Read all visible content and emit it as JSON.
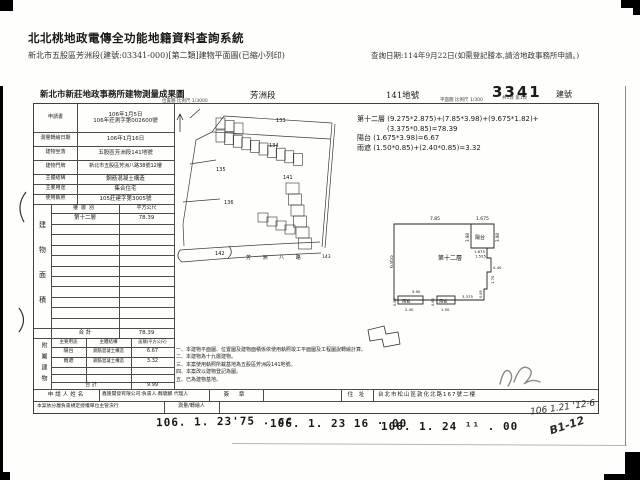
{
  "header": {
    "system_title": "北北桃地政電傳全功能地籍資料查詢系統",
    "doc_subtitle": "新北市五股區芳洲段(建號:03341-000)[第二類]建物平面圖(已縮小列印)",
    "query_date": "查詢日期:114年9月22日(如需登記謄本,請洽地政事務所申請。)"
  },
  "form_header": {
    "office_title": "新北市新莊地政事務所建物測量成果圖",
    "section_name": "芳洲段",
    "land_no": "141地號",
    "building_no": "3341",
    "building_no_label": "建號",
    "map_scale": "位置圖 比例尺 1/3000",
    "plan_scale": "平面圖 比例尺 1/300",
    "page_info": "共1頁 第1頁"
  },
  "info_table": {
    "rows": [
      {
        "label": "申請書",
        "value": "106年1月5日",
        "value2": "106年莊測字第002600號"
      },
      {
        "label": "測量轉繪日期",
        "value": "106年1月16日"
      },
      {
        "label": "建物坐落",
        "value": "五股區芳洲段141地號"
      },
      {
        "label": "建物門牌",
        "value": "新北市五股區芳洲八路38號12樓"
      },
      {
        "label": "主體結構",
        "value": "鋼筋混凝土構造"
      },
      {
        "label": "主要用途",
        "value": "集合住宅"
      },
      {
        "label": "使用執照",
        "value": "105莊建字第3005號"
      }
    ]
  },
  "floor_area_table": {
    "side_label": "建物面積",
    "col1": "樓層別",
    "col2": "平方公尺",
    "floor_label": "第十二層",
    "floor_area": "78.39",
    "total_label": "合  計",
    "total_area": "78.39"
  },
  "annex_table": {
    "side_label": "附屬建物",
    "col1": "主要用途",
    "col2": "主體結構",
    "col3": "面積(平方公尺)",
    "rows": [
      {
        "use": "陽台",
        "structure": "鋼筋混凝土構造",
        "area": "6.67"
      },
      {
        "use": "雨遮",
        "structure": "鋼筋混凝土構造",
        "area": "3.32"
      }
    ],
    "total_label": "合  計",
    "total_area": "9.99"
  },
  "applicant_row": {
    "label": "申請人姓名",
    "company": "鑫隆開發有限公司:負責人.魏聰麟 代理人",
    "sign_label": "簽 章",
    "addr_label": "住 址",
    "address": "台北市松山區敦化北路167號二樓"
  },
  "authority_row": {
    "label": "本案依分層負責規定授權單位主管決行",
    "surveyor_label": "測量/轉繪人"
  },
  "area_formula": {
    "line1": "第十二層 (9.275*2.875)+(7.85*3.98)+(9.675*1.82)+",
    "line2": "(3.375*0.85)=78.39",
    "line3": "陽台 (1.675*3.98)=6.67",
    "line4": "雨遮 (1.50*0.85)+(2.40*0.85)=3.32"
  },
  "notes": [
    "一、本建物平面圖、位置圖及建物面積係依使用執照竣工平面圖及工程圖說轉繪計算。",
    "二、本建物為十九層建物。",
    "三、本案使用執照所載基地為五股區芳洲段141地號。",
    "四、本案改以建物登記為圖。",
    "五、已為建物基地。"
  ],
  "site_map": {
    "p133": "133",
    "p134": "134",
    "p135": "135",
    "p136": "136",
    "p141": "141",
    "p142": "142",
    "p143": "143",
    "road_name": "芳 洲 八 路"
  },
  "floor_plan": {
    "room": "第十二層",
    "balcony": "陽台",
    "canopy1": "雨遮",
    "canopy2": "雨遮",
    "dims": {
      "top_w": "7.85",
      "balcony_w": "1.675",
      "left_h": "6.855",
      "balcony_h_l": "3.98",
      "balcony_h_r": "3.98",
      "step_w1": "1.675",
      "step_w2": "1.525",
      "right_s1": "0.40",
      "right_s2": "1.70",
      "canopy_span": "5.90",
      "canopy1_w": "2.40",
      "canopy2_w": "1.50",
      "bottom_w": "3.375",
      "canopy1_h": "0.85",
      "canopy2_h": "0.85",
      "step_h": "0.85"
    }
  },
  "stamps": {
    "s1": "106. 1. 23'75 . cc",
    "s2": "106. 1. 23  16 · 00",
    "s3": "106. 1. 24 ¹¹ . 00",
    "hw_date": "106 1.21 '12·6",
    "hw_note": "B1-12"
  }
}
